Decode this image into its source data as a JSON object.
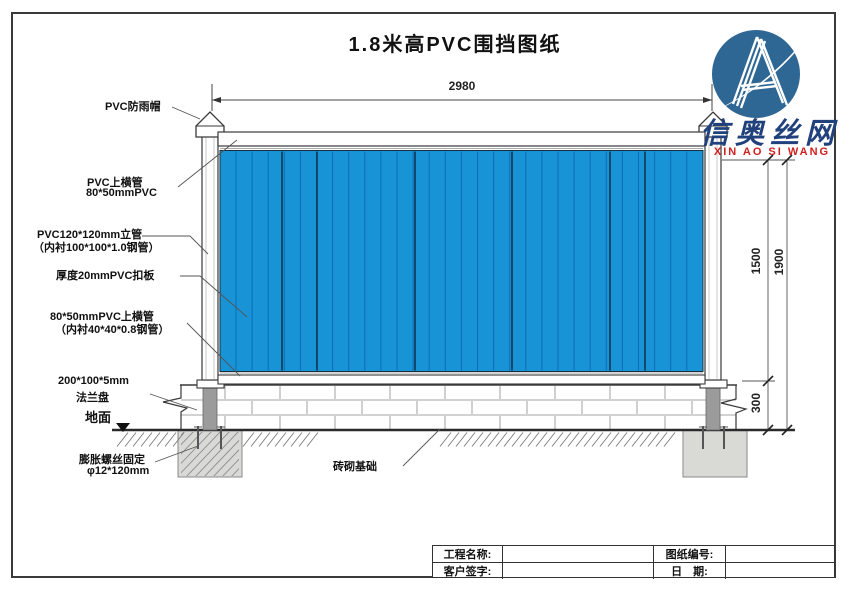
{
  "title": "1.8米高PVC围挡图纸",
  "logo": {
    "company_cn": "信奥丝网",
    "company_en": "XIN AO SI WANG"
  },
  "labels": {
    "rain_cap": "PVC防雨帽",
    "top_rail_1": "PVC上横管",
    "top_rail_2": "80*50mmPVC",
    "post_1": "PVC120*120mm立管",
    "post_2": "（内衬100*100*1.0钢管）",
    "panel": "厚度20mmPVC扣板",
    "mid_rail_1": "80*50mmPVC上横管",
    "mid_rail_2": "（内衬40*40*0.8钢管）",
    "flange_1": "200*100*5mm",
    "flange_2": "法兰盘",
    "ground": "地面",
    "anchor_1": "膨胀螺丝固定",
    "anchor_2": "φ12*120mm",
    "foundation": "砖砌基础"
  },
  "dimensions": {
    "width": "2980",
    "panel_height": "1500",
    "total_height": "1900",
    "base_height": "300"
  },
  "table": {
    "project_label": "工程名称:",
    "project_value": "",
    "drawing_no_label": "图纸编号:",
    "drawing_no_value": "",
    "signature_label": "客户签字:",
    "signature_value": "",
    "date_label": "日　期:",
    "date_value": ""
  },
  "colors": {
    "panel_blue": "#1793d6",
    "panel_line": "#0d6cb4",
    "panel_dark_line": "#123f5e",
    "steel_gray": "#9b9b9b",
    "foundation_gray": "#d9d9d6",
    "logo_blue": "#2e6694",
    "logo_text_blue": "#21417d",
    "logo_text_red": "#d01f1f"
  }
}
